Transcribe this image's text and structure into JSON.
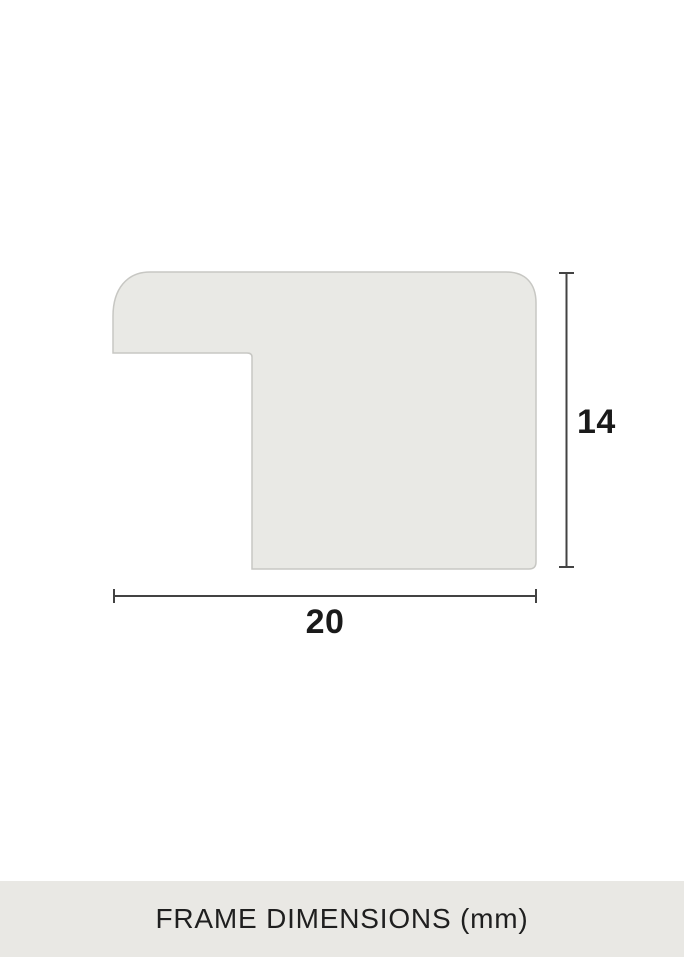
{
  "diagram": {
    "width_label": "20",
    "height_label": "14",
    "width_mm": 20,
    "height_mm": 14,
    "unit": "mm"
  },
  "caption": {
    "text": "FRAME DIMENSIONS (mm)"
  },
  "colors": {
    "background": "#ffffff",
    "profile_fill": "#e9e9e5",
    "profile_stroke": "#c7c7c3",
    "dimension_line": "#434343",
    "label_text": "#1a1a1a",
    "caption_bg": "#e9e8e4",
    "caption_text": "#1f1f1f"
  }
}
